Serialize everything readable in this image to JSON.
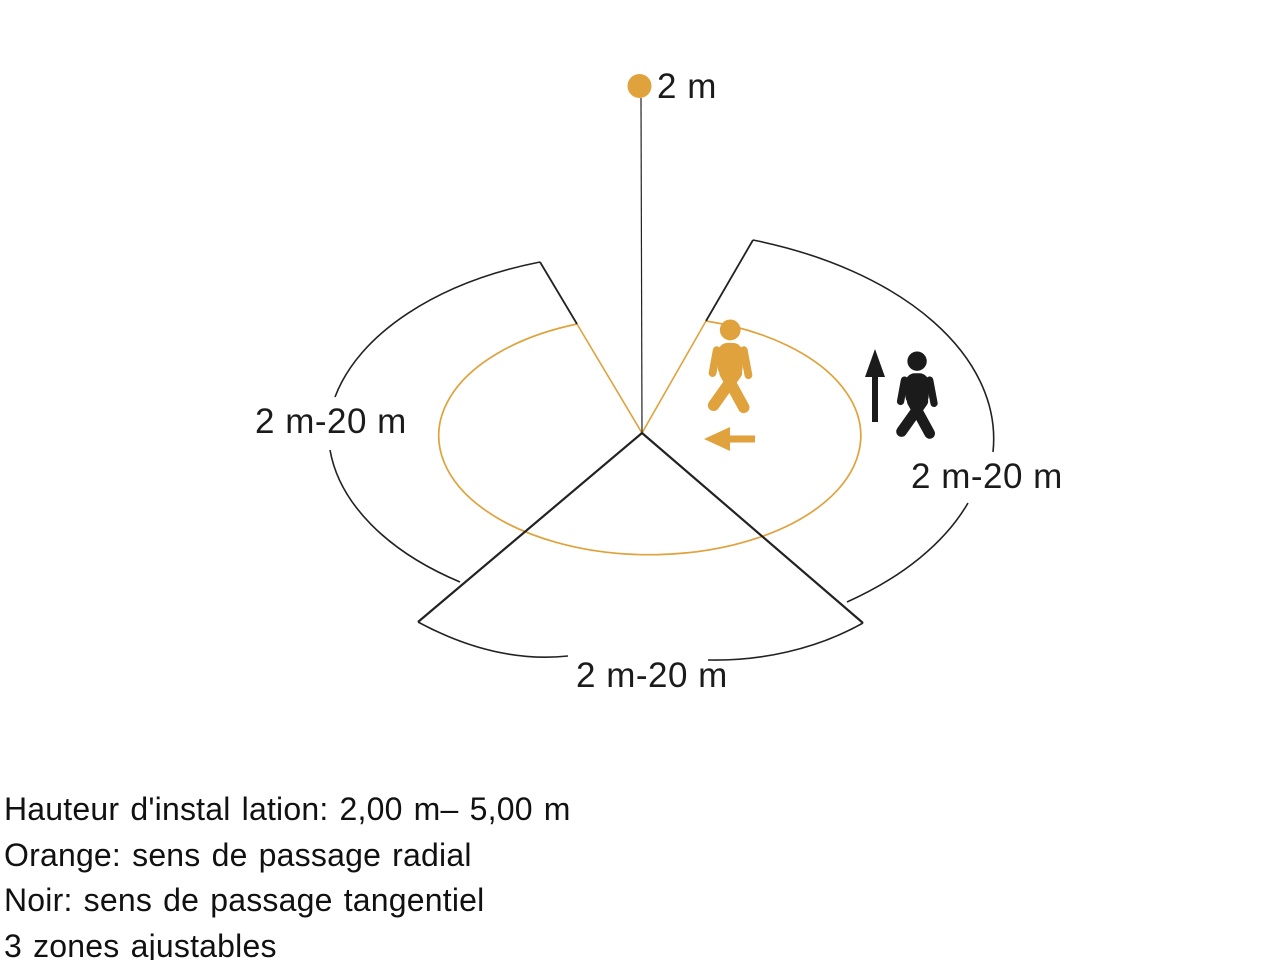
{
  "colors": {
    "orange": "#DFA23C",
    "line_black": "#222222",
    "text_black": "#111111"
  },
  "diagram": {
    "mount_height_label": "2 m",
    "zones": {
      "left_label": "2 m-20 m",
      "right_label": "2 m-20 m",
      "bottom_label": "2 m-20 m"
    },
    "icons": [
      "sensor-dot",
      "person-walking-radial",
      "person-walking-tangential",
      "arrow-left",
      "arrow-up"
    ]
  },
  "legend": {
    "lines": [
      "Hauteur d'instal lation: 2,00 m– 5,00 m",
      "Orange: sens de passage radial",
      "Noir: sens de passage tangentiel",
      "3 zones ajustables"
    ]
  }
}
